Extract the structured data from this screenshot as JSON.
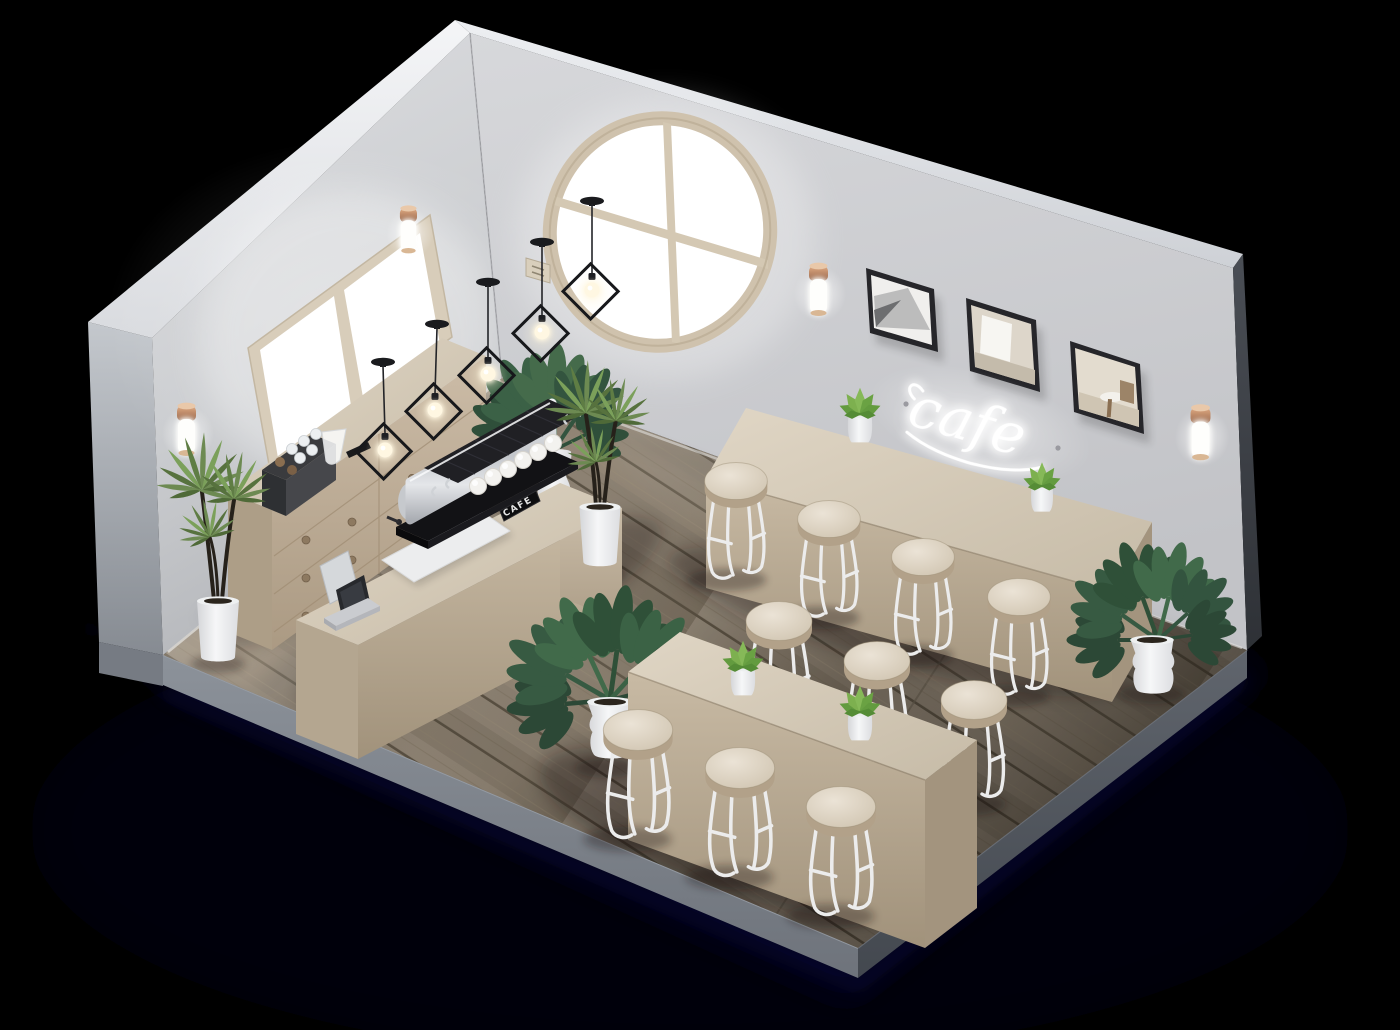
{
  "scene": {
    "type": "isometric-3d-render",
    "subject": "minimal scandinavian cafe interior cutaway with open ceiling",
    "background_color": "#000000",
    "text": {
      "neon_sign": "cafe",
      "espresso_machine_label": "CAFE"
    },
    "palette": {
      "wall": "#d3d5d8",
      "wall_top_edge": "#eef0f3",
      "floor_wood": "#877b6b",
      "counter_wood": "#d3c7b4",
      "stool_seat_wood": "#e0d7c8",
      "stool_legs": "#ececec",
      "copper_fixture": "#c08a66",
      "monstera_green": "#3a5f44",
      "succulent_green": "#7db04f",
      "neon_glow": "#ffffff",
      "window_light": "#ffffff",
      "picture_frame": "#26262a",
      "pot_white": "#f2f3f4",
      "ground_shadow": "#06051d"
    },
    "objects": {
      "windows": [
        {
          "name": "rectangular-window",
          "wall": "left",
          "panes": 2
        },
        {
          "name": "round-window",
          "wall": "right",
          "mullion": "cross"
        }
      ],
      "pendant_lights": 5,
      "wall_sconces": 4,
      "framed_pictures": 3,
      "stools": 10,
      "espresso_cups": 6,
      "tables": [
        {
          "name": "communal-table",
          "plants_on_top": 2
        },
        {
          "name": "wall-bench",
          "plants_on_top": 2
        }
      ],
      "counters": [
        {
          "name": "service-counter",
          "items": [
            "pos-register",
            "serving-mat",
            "espresso-machine"
          ]
        },
        {
          "name": "back-cabinet",
          "drawers": 5,
          "items": [
            "cup-organizer",
            "glass-carafe",
            "menu-tablet"
          ]
        }
      ],
      "potted_plants": [
        {
          "name": "yucca",
          "location": "left-corner"
        },
        {
          "name": "monstera",
          "location": "behind-espresso-machine"
        },
        {
          "name": "yucca",
          "location": "beside-espresso-machine"
        },
        {
          "name": "monstera",
          "location": "in-front-of-counter"
        },
        {
          "name": "monstera",
          "location": "right-wall-end"
        },
        {
          "name": "succulent",
          "location": "wall-bench-left"
        },
        {
          "name": "succulent",
          "location": "wall-bench-right"
        },
        {
          "name": "succulent",
          "location": "communal-table-left"
        },
        {
          "name": "succulent",
          "location": "communal-table-right"
        }
      ]
    }
  }
}
